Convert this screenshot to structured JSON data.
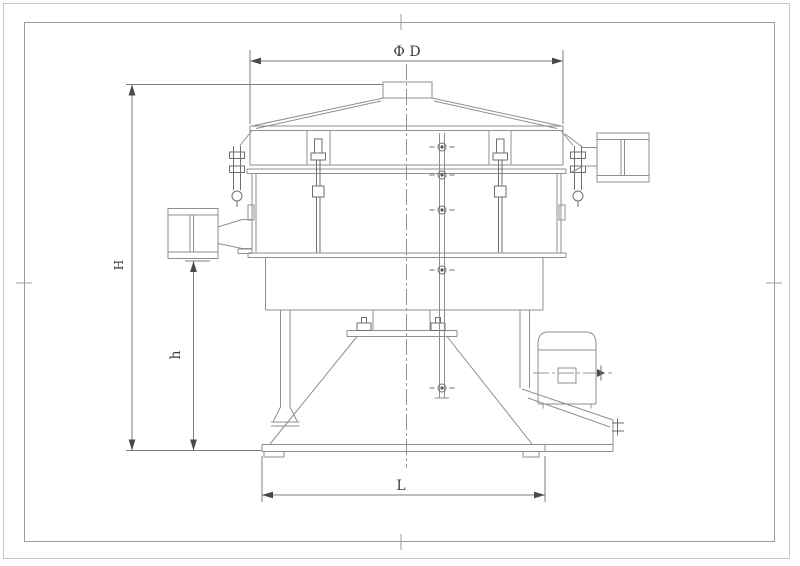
{
  "labels": {
    "diameter": "Φ D",
    "overall_height": "H",
    "outlet_height": "h",
    "base_width": "L"
  },
  "colors": {
    "background": "#ffffff",
    "frame_outer": "#c6c6c6",
    "frame_inner": "#9c9c9c",
    "line": "#8f8f8f",
    "line_dark": "#6e6e6e",
    "dimension": "#7d7d7d",
    "text": "#3a3a3a"
  }
}
